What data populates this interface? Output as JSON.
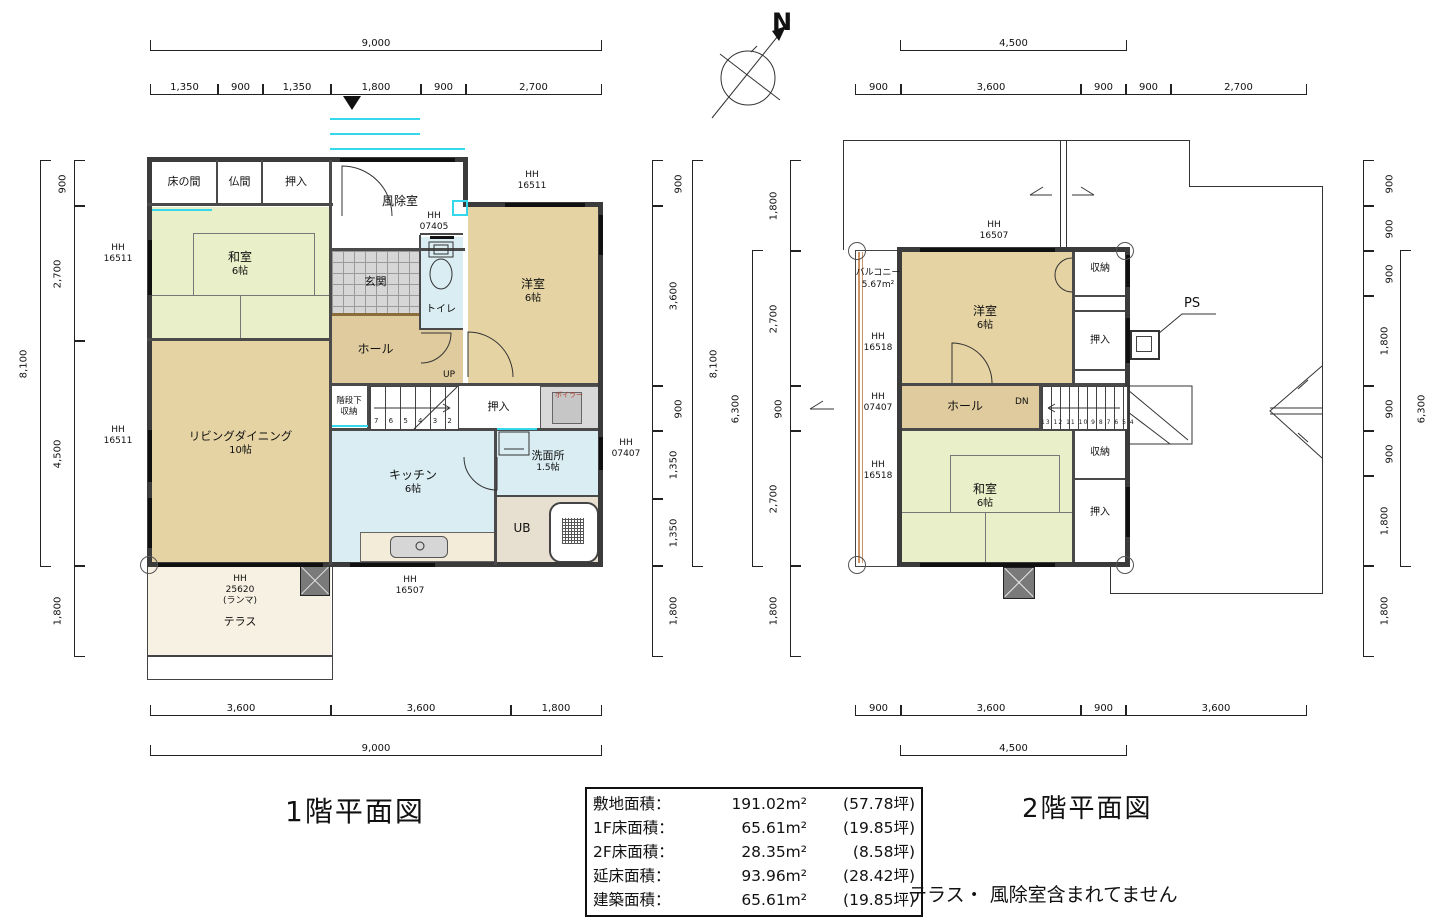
{
  "colors": {
    "tatami": "#e9efc8",
    "wood_floor": "#e5d3a3",
    "hall_floor": "#dfcb9d",
    "water_area": "#d9edf3",
    "terrace": "#f7f1e3",
    "tile": "#d6d6d6",
    "accent_cyan": "#35d8ea",
    "balcony_rail": "#cf9465",
    "wall": "#3b3b3b"
  },
  "compass": {
    "north": "N"
  },
  "floor1": {
    "title": "1階平面図",
    "dim_top_total": "9,000",
    "dim_top": [
      "1,350",
      "900",
      "1,350",
      "1,800",
      "900",
      "2,700"
    ],
    "dim_bottom": [
      "3,600",
      "3,600",
      "1,800"
    ],
    "dim_bottom_total": "9,000",
    "dim_left": [
      "900",
      "2,700",
      "4,500",
      "1,800"
    ],
    "dim_left_total": "8,100",
    "dim_right": [
      "900",
      "3,600",
      "900",
      "1,350",
      "1,350",
      "1,800"
    ],
    "dim_right_total": "8,100",
    "rooms": {
      "tokonoma": "床の間",
      "butsuma": "仏間",
      "oshiire_top": "押入",
      "fujoshitsu": "風除室",
      "genkan": "玄関",
      "toilet": "トイレ",
      "washitsu_name": "和室",
      "washitsu_size": "6帖",
      "hall": "ホール",
      "up": "UP",
      "kaidan_shuno_1": "階段下",
      "kaidan_shuno_2": "収納",
      "yoshitsu_name": "洋室",
      "yoshitsu_size": "6帖",
      "oshiire_mid": "押入",
      "boiler": "ボイラー",
      "senmenjo_name": "洗面所",
      "senmenjo_size": "1.5帖",
      "ub": "UB",
      "living_name": "リビングダイニング",
      "living_size": "10帖",
      "kitchen_name": "キッチン",
      "kitchen_size": "6帖",
      "terrace": "テラス"
    },
    "stairs": "7 6 5 4 3 2",
    "hh_prefix": "HH",
    "hh": {
      "left_top": "16511",
      "left_bottom": "16511",
      "yoshitsu_top": "16511",
      "genkan": "07405",
      "senmenjo": "07407",
      "kitchen_bottom": "16507",
      "terrace_num": "25620",
      "terrace_sub": "(ランマ)"
    }
  },
  "floor2": {
    "title": "2階平面図",
    "dim_top_total": "4,500",
    "dim_top": [
      "900",
      "3,600",
      "900",
      "900",
      "2,700"
    ],
    "dim_bottom": [
      "900",
      "3,600",
      "900",
      "3,600"
    ],
    "dim_bottom_total": "4,500",
    "dim_left": [
      "1,800",
      "2,700",
      "900",
      "2,700",
      "1,800"
    ],
    "dim_left_total": "6,300",
    "dim_right": [
      "900",
      "900",
      "900",
      "1,800",
      "900",
      "900",
      "1,800",
      "1,800"
    ],
    "dim_right_total": "6,300",
    "rooms": {
      "balcony_name": "バルコニー",
      "balcony_size": "5.67m²",
      "yoshitsu_name": "洋室",
      "yoshitsu_size": "6帖",
      "shuno_top": "収納",
      "oshiire_top": "押入",
      "ps": "PS",
      "hall": "ホール",
      "dn": "DN",
      "washitsu_name": "和室",
      "washitsu_size": "6帖",
      "shuno_bottom": "収納",
      "oshiire_bottom": "押入"
    },
    "stairs": "13 12 11 10 9 8 7 6 5 4",
    "hh_prefix": "HH",
    "hh": {
      "top": "16507",
      "left_top": "16518",
      "left_mid": "07407",
      "left_bottom": "16518"
    }
  },
  "area_table": {
    "rows": [
      {
        "label": "敷地面積：",
        "value": "191.02m²",
        "tsubo": "(57.78坪)"
      },
      {
        "label": "1F床面積：",
        "value": "65.61m²",
        "tsubo": "(19.85坪)"
      },
      {
        "label": "2F床面積：",
        "value": "28.35m²",
        "tsubo": "(8.58坪)"
      },
      {
        "label": "延床面積：",
        "value": "93.96m²",
        "tsubo": "(28.42坪)"
      },
      {
        "label": "建築面積：",
        "value": "65.61m²",
        "tsubo": "(19.85坪)"
      }
    ]
  },
  "note": "テラス・ 風除室含まれてません"
}
